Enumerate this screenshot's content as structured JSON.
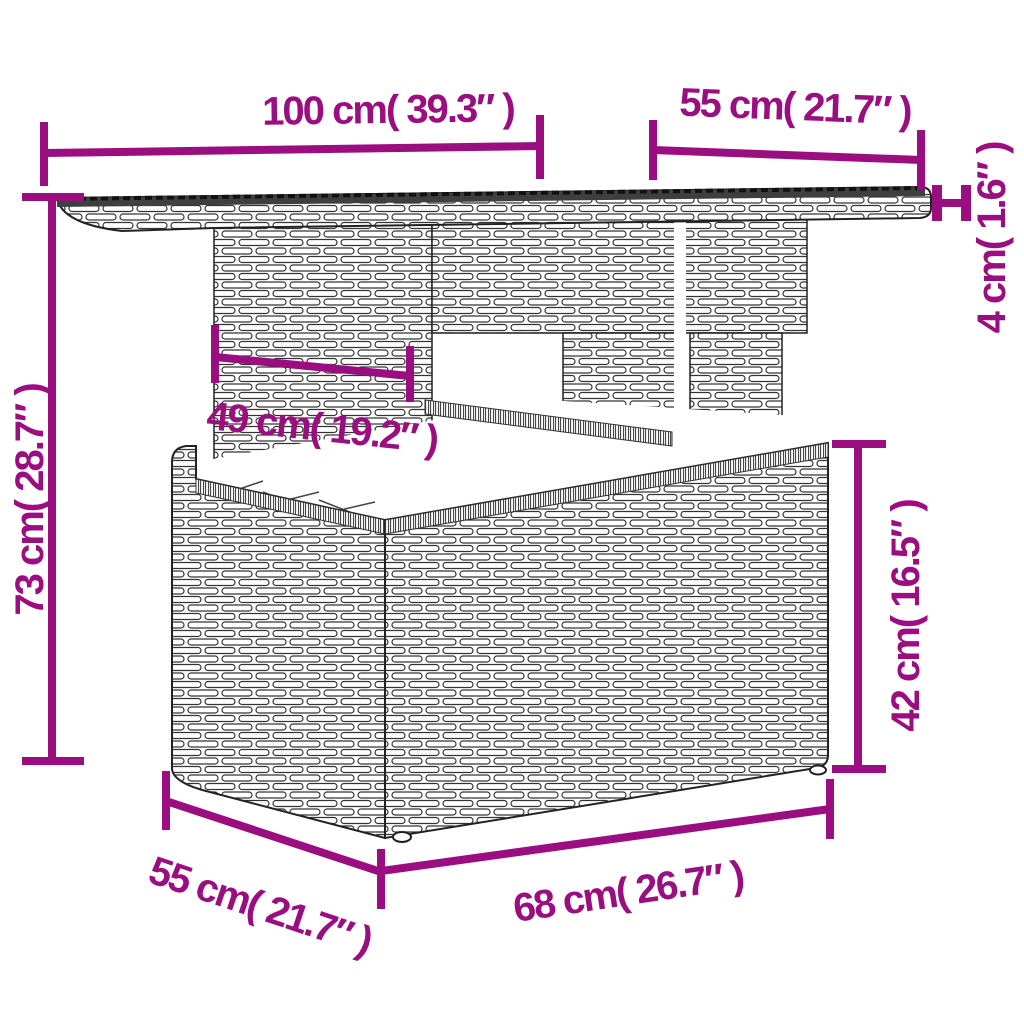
{
  "diagram": {
    "accent_color": "#9B0E80",
    "line_color": "#222222",
    "background": "#ffffff",
    "labels": {
      "top_width": "100 cm( 39.3″ )",
      "top_depth": "55 cm( 21.7″ )",
      "top_thickness": "4 cm( 1.6″ )",
      "overall_height": "73 cm( 28.7″ )",
      "pedestal_width": "49 cm( 19.2″ )",
      "base_height": "42 cm( 16.5″ )",
      "base_depth": "55 cm( 21.7″ )",
      "base_width": "68 cm( 26.7″ )"
    }
  }
}
